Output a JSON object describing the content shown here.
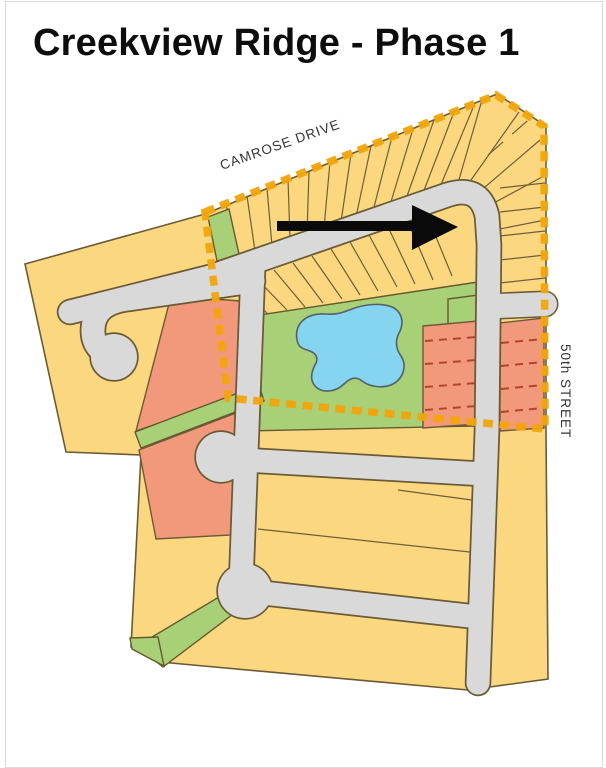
{
  "page": {
    "title": "Creekview Ridge - Phase 1"
  },
  "map": {
    "street_labels": [
      {
        "id": "camrose-drive",
        "text": "CAMROSE DRIVE"
      },
      {
        "id": "50th-street",
        "text": "50th STREET"
      }
    ],
    "icons": {
      "direction_arrow": "direction-arrow-east"
    },
    "colors": {
      "lot_yellow": "#FBD77F",
      "lot_salmon": "#F2997C",
      "greenspace_green": "#A8D077",
      "pond_blue": "#85D4F0",
      "road_gray": "#D9D9D9",
      "outline_dark": "#6B5B35",
      "phase_boundary_orange": "#F2A60A",
      "lot_dash_red": "#B0442C",
      "arrow_black": "#0A0A0A",
      "title_black": "#0D0D0D"
    }
  }
}
